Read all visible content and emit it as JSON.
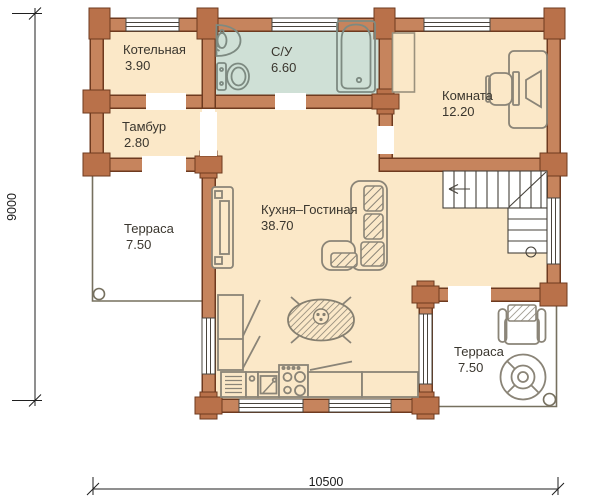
{
  "plan": {
    "type": "floor-plan",
    "rooms": {
      "kotelnaya": {
        "name": "Котельная",
        "area": "3.90"
      },
      "su": {
        "name": "С/У",
        "area": "6.60"
      },
      "komnata": {
        "name": "Комната",
        "area": "12.20"
      },
      "tambur": {
        "name": "Тамбур",
        "area": "2.80"
      },
      "terrace_left": {
        "name": "Терраса",
        "area": "7.50"
      },
      "kitchen_living": {
        "name": "Кухня–Гостиная",
        "area": "38.70"
      },
      "terrace_right": {
        "name": "Терраса",
        "area": "7.50"
      }
    },
    "dimensions": {
      "bottom": "10500",
      "left": "9000"
    },
    "colors": {
      "wall": "#c6845d",
      "wall_post": "#b9714a",
      "wall_outline": "#6e3a1f",
      "floor": "#fbe8c8",
      "bathroom_floor": "#cfe0d6",
      "furniture_outline": "#8a8477",
      "fixture_outline": "#7d8a81",
      "background": "#ffffff"
    }
  }
}
